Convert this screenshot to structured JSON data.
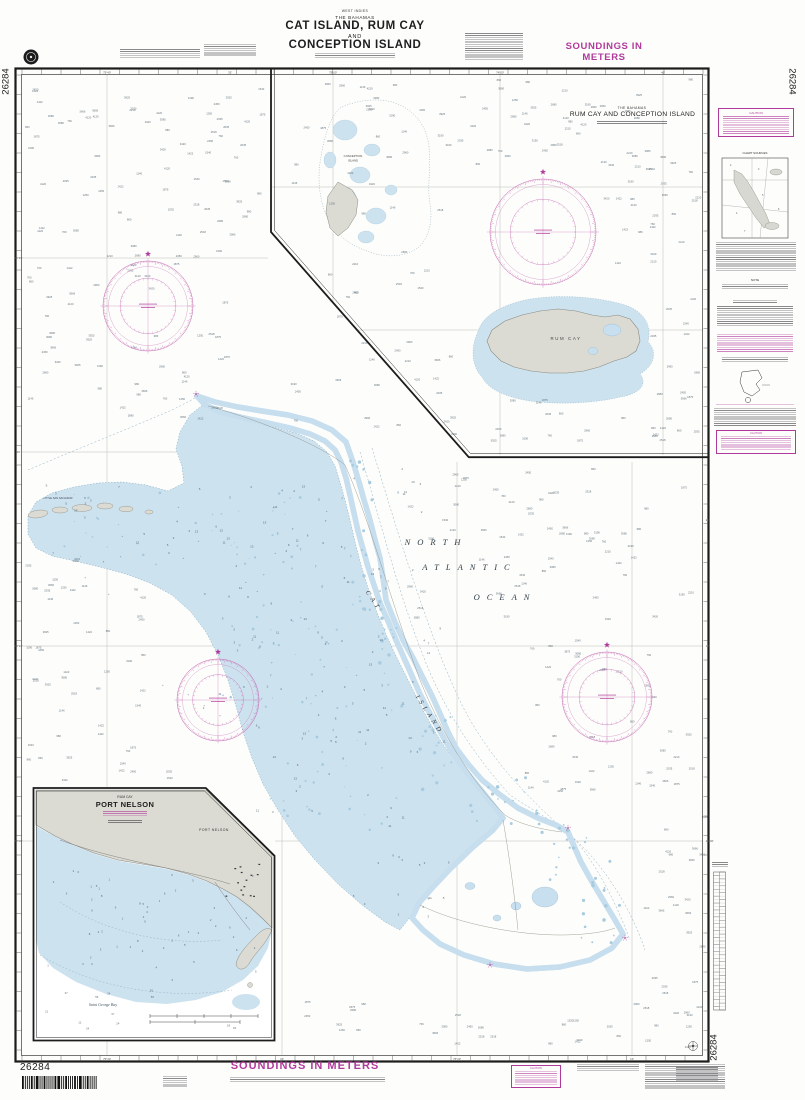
{
  "chart": {
    "number": "26284",
    "heading_region": "WEST INDIES",
    "heading_country": "THE BAHAMAS",
    "title_line1": "CAT ISLAND, RUM CAY",
    "title_line2": "AND",
    "title_line3": "CONCEPTION ISLAND",
    "soundings_top": "SOUNDINGS IN METERS",
    "soundings_bottom": "SOUNDINGS IN METERS"
  },
  "insets": {
    "rum_cay": {
      "country": "THE BAHAMAS",
      "title": "RUM CAY AND CONCEPTION ISLAND"
    },
    "port_nelson": {
      "super": "RUM CAY",
      "title": "PORT NELSON",
      "bay": "Saint George Bay",
      "town": "PORT NELSON"
    }
  },
  "labels": {
    "ocean1": "NORTH",
    "ocean2": "ATLANTIC",
    "ocean3": "OCEAN",
    "cat1": "CAT",
    "cat2": "ISLAND",
    "rum_cay": "RUM CAY",
    "conception1": "CONCEPTION",
    "conception2": "ISLAND",
    "little_san_salvador": "LITTLE SAN SALVADOR"
  },
  "margin": {
    "caution": "CAUTION",
    "chart_sources": "CHART SOURCES",
    "note": "NOTE"
  },
  "graticule": {
    "top_main": [
      {
        "x": 107,
        "t": "75°40'"
      },
      {
        "x": 230,
        "t": "35'"
      }
    ],
    "top_inset": [
      {
        "x": 333,
        "t": "75°00'"
      },
      {
        "x": 500,
        "t": "74°50'"
      },
      {
        "x": 663,
        "t": "40'"
      }
    ],
    "bottom": [
      {
        "x": 107,
        "t": "75°40'"
      },
      {
        "x": 282,
        "t": "30'"
      },
      {
        "x": 457,
        "t": "75°20'"
      },
      {
        "x": 632,
        "t": "10'"
      }
    ],
    "left": [
      {
        "y": 258,
        "t": "24°30'"
      },
      {
        "y": 452,
        "t": "20'"
      },
      {
        "y": 646,
        "t": "24°10'"
      },
      {
        "y": 841,
        "t": "24°00'"
      }
    ],
    "right": [
      {
        "y": 520,
        "t": "20'"
      },
      {
        "y": 646,
        "t": "10'"
      },
      {
        "y": 841,
        "t": "24°00'"
      }
    ]
  },
  "soundings": {
    "deep_pool": [
      "2450",
      "3080",
      "1250",
      "1875",
      "2210",
      "3420",
      "760",
      "1540",
      "2960",
      "4120",
      "980",
      "2035",
      "3666",
      "1422",
      "2680",
      "860",
      "3190",
      "2518",
      "1146",
      "3925"
    ],
    "bank_pool": [
      "2",
      "3",
      "4",
      "5",
      "6",
      "7",
      "9",
      "11",
      "13",
      "2",
      "3",
      "5"
    ],
    "port_shallow_pool": [
      "1",
      "2",
      "2",
      "3",
      "4",
      "5",
      "6",
      "8"
    ],
    "port_deep_pool": [
      "12",
      "18",
      "24",
      "37",
      "55",
      "73"
    ]
  },
  "colors": {
    "magenta": "#b03a9c",
    "rose": "#c66bb5",
    "land": "#dbdbd4",
    "land_stroke": "#8a8a80",
    "shallow": "#cde2ef",
    "fringe": "#c6deee",
    "speckle": "#a8cbe0",
    "sounding": "#475a66",
    "grid": "#bcbcb6"
  }
}
